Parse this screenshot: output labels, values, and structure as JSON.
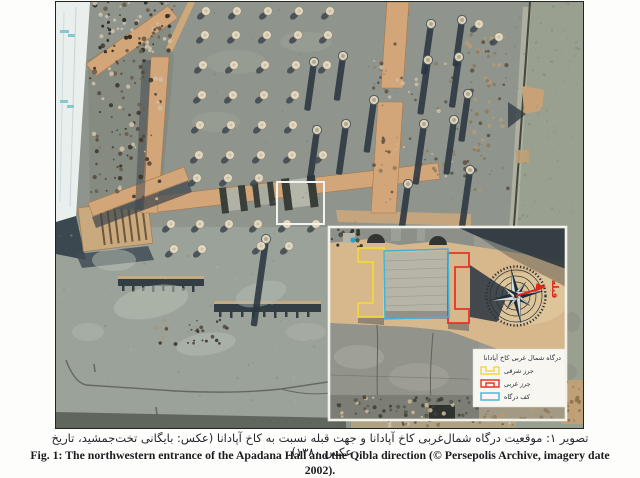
{
  "page": {
    "background": "#ffffff"
  },
  "figure": {
    "caption_fa": "تصویر ۱: موقعیت درگاه شمال‌غربی کاخ آپادانا و جهت قبله نسبت به کاخ آپادانا (عکس: بایگانی تخت‌جمشید، تاریخ عکس ۱۳۸۰).",
    "caption_en": "Fig. 1: The northwestern entrance of the Apadana Hall and the Qibla direction (© Persepolis Archive, imagery date 2002)."
  },
  "inset": {
    "qibla_label": "قبله",
    "qibla_color": "#e02616",
    "legend": {
      "title": "درگاه شمال غربی کاخ آپادانا",
      "items": [
        {
          "label": "جرز شرقی",
          "color": "#f0d83c"
        },
        {
          "label": "جرز غربی",
          "color": "#e63524"
        },
        {
          "label": "کف درگاه",
          "color": "#3fb3dc"
        }
      ]
    }
  }
}
